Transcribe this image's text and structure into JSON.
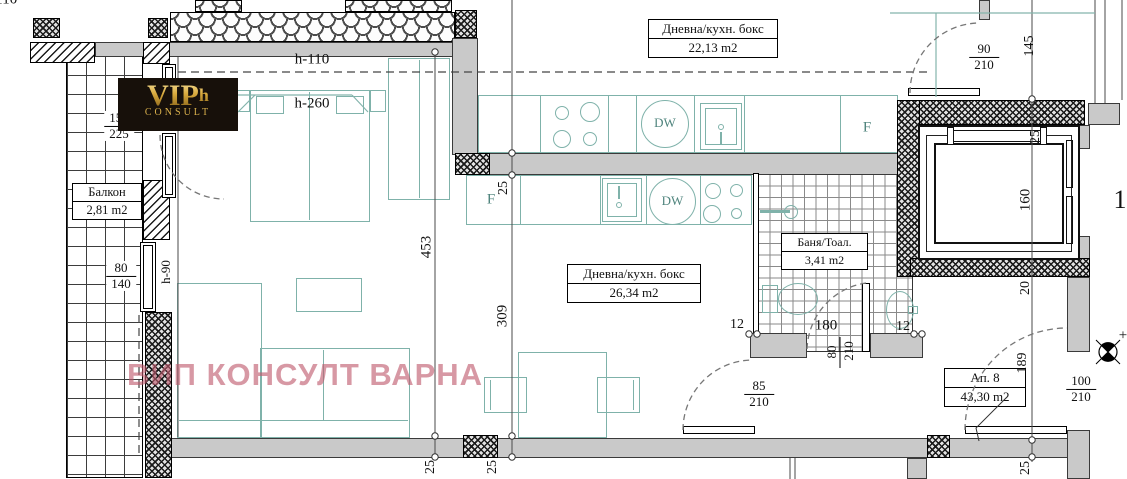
{
  "watermark": {
    "text": "ВИП КОНСУЛТ ВАРНА"
  },
  "logo": {
    "main": "VIP",
    "suffix": "h",
    "sub": "CONSULT"
  },
  "rooms": {
    "upper_unit": {
      "name": "Дневна/кухн. бокс",
      "area": "22,13 m2"
    },
    "living": {
      "name": "Дневна/кухн. бокс",
      "area": "26,34 m2"
    },
    "bathroom": {
      "name": "Баня/Тоал.",
      "area": "3,41 m2"
    },
    "balcony": {
      "name": "Балкон",
      "area": "2,81 m2"
    },
    "apartment": {
      "name": "Ап. 8",
      "area": "43,30 m2"
    }
  },
  "appliances": {
    "dishwasher": "DW",
    "fridge": "F"
  },
  "dims": {
    "h110": "h-110",
    "h260": "h-260",
    "h90": "h-90",
    "v453": "453",
    "v309": "309",
    "v145": "145",
    "v160": "160",
    "v20": "20",
    "v189": "189",
    "v25": "25",
    "n12": "12",
    "n180": "180",
    "n80": "80",
    "n210": "210",
    "edge_number": "1",
    "north_plus": "+"
  },
  "fractions": {
    "win150": {
      "num": "150",
      "den": "225"
    },
    "win80": {
      "num": "80",
      "den": "140"
    },
    "door90": {
      "num": "90",
      "den": "210"
    },
    "door85": {
      "num": "85",
      "den": "210"
    },
    "door100": {
      "num": "100",
      "den": "210"
    }
  },
  "colors": {
    "furniture": "#7fb2aa",
    "wall_fill": "#c9c9c9",
    "watermark": "#bf5a6e",
    "gold": "#d8a93c"
  }
}
